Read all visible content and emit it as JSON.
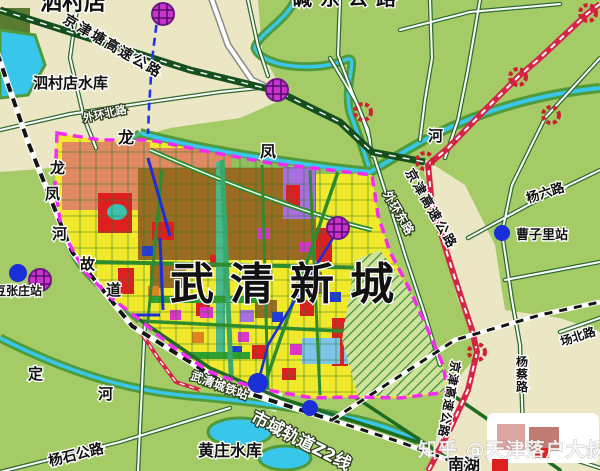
{
  "map": {
    "title": "武清新城",
    "watermark": "知乎 @天津落户大叔",
    "labels": {
      "sicundian_town": "泗村店",
      "jingjintang_expressway": "京津塘高速公路",
      "sicundian_reservoir": "泗村店水库",
      "jiandong_road": "碱东公路",
      "waihuan_north_road": "外环北路",
      "waihuan_east_road": "外环东路",
      "jingjin_expressway_north": "京津高速公路",
      "jingjin_expressway_south": "京津高速公路",
      "yangliu_road": "杨六路",
      "caozili_station": "曹子里站",
      "river_he": "河",
      "longfeng_river_char1": "龙",
      "longfeng_river_char2": "凤",
      "longfeng_old_channel": {
        "c1": "龙",
        "c2": "凤",
        "c3": "河",
        "c4": "故",
        "c5": "道"
      },
      "douzhangzhuang_station": "豆张庄站",
      "ding_river": {
        "c1": "定",
        "c2": "河"
      },
      "yangshi_road": "杨石公路",
      "huangzhuang_reservoir": "黄庄水库",
      "z2_rail_line": "市域轨道Z2线",
      "wuqing_rail_station": "武清城铁站",
      "yangcai_road": "杨蔡路",
      "changbei_road": "场北路",
      "nanhu": "南湖"
    },
    "palette": {
      "land_green": "#a5cb66",
      "beige_zone": "#ebe6c3",
      "water_cyan": "#38c6ea",
      "river_bank_green": "#4f9a3a",
      "expressway_green": "#164f1e",
      "expressway_red": "#d5264a",
      "boundary_magenta": "#f32cf3",
      "metro_dash_blue": "#2233ee",
      "railway_black": "#141414",
      "city_yellow": "#f0e92c",
      "city_brown": "#9a6b21",
      "city_red": "#dd1f1f",
      "city_magenta": "#dd33cc",
      "city_purple": "#a96fe0",
      "city_cyan": "#7cc4e8",
      "city_salmon": "#e08a62",
      "park_green": "#2f9e33",
      "station_dot_blue": "#1b2fd9",
      "station_circle_purple": "#cc33cc",
      "interchange_ring_red": "#cc2033"
    }
  }
}
